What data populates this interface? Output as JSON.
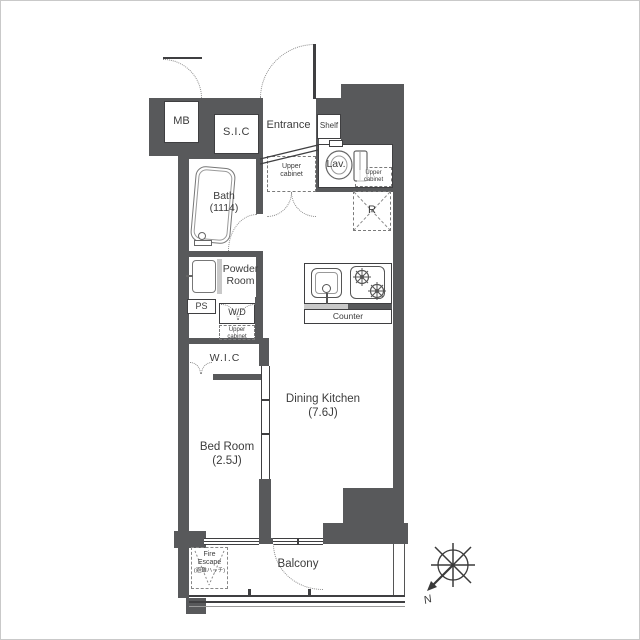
{
  "labels": {
    "mb": "MB",
    "sic": "S.I.C",
    "entrance": "Entrance",
    "shelf": "Shelf",
    "upper_cabinet_entrance": "Upper cabinet",
    "lav": "Lav.",
    "upper_cabinet_lav": "Upper cabinet",
    "bath_name": "Bath",
    "bath_size": "(1114)",
    "refrigerator": "R",
    "powder_room": "Powder Room",
    "ps": "PS",
    "washer_dryer": "W/D",
    "upper_cabinet_wd": "Upper cabinet",
    "wic": "W.I.C",
    "counter": "Counter",
    "dining_kitchen_name": "Dining Kitchen",
    "dining_kitchen_size": "(7.6J)",
    "bedroom_name": "Bed Room",
    "bedroom_size": "(2.5J)",
    "fire_escape_line1": "Fire",
    "fire_escape_line2": "Escape",
    "fire_escape_line3": "(避難ハッチ)",
    "balcony": "Balcony",
    "compass_north": "N"
  },
  "colors": {
    "wall": "#58595B",
    "line": "#3F3F41",
    "fixture_line": "#777777",
    "text": "#3C3C3C",
    "background": "#FFFFFF"
  }
}
